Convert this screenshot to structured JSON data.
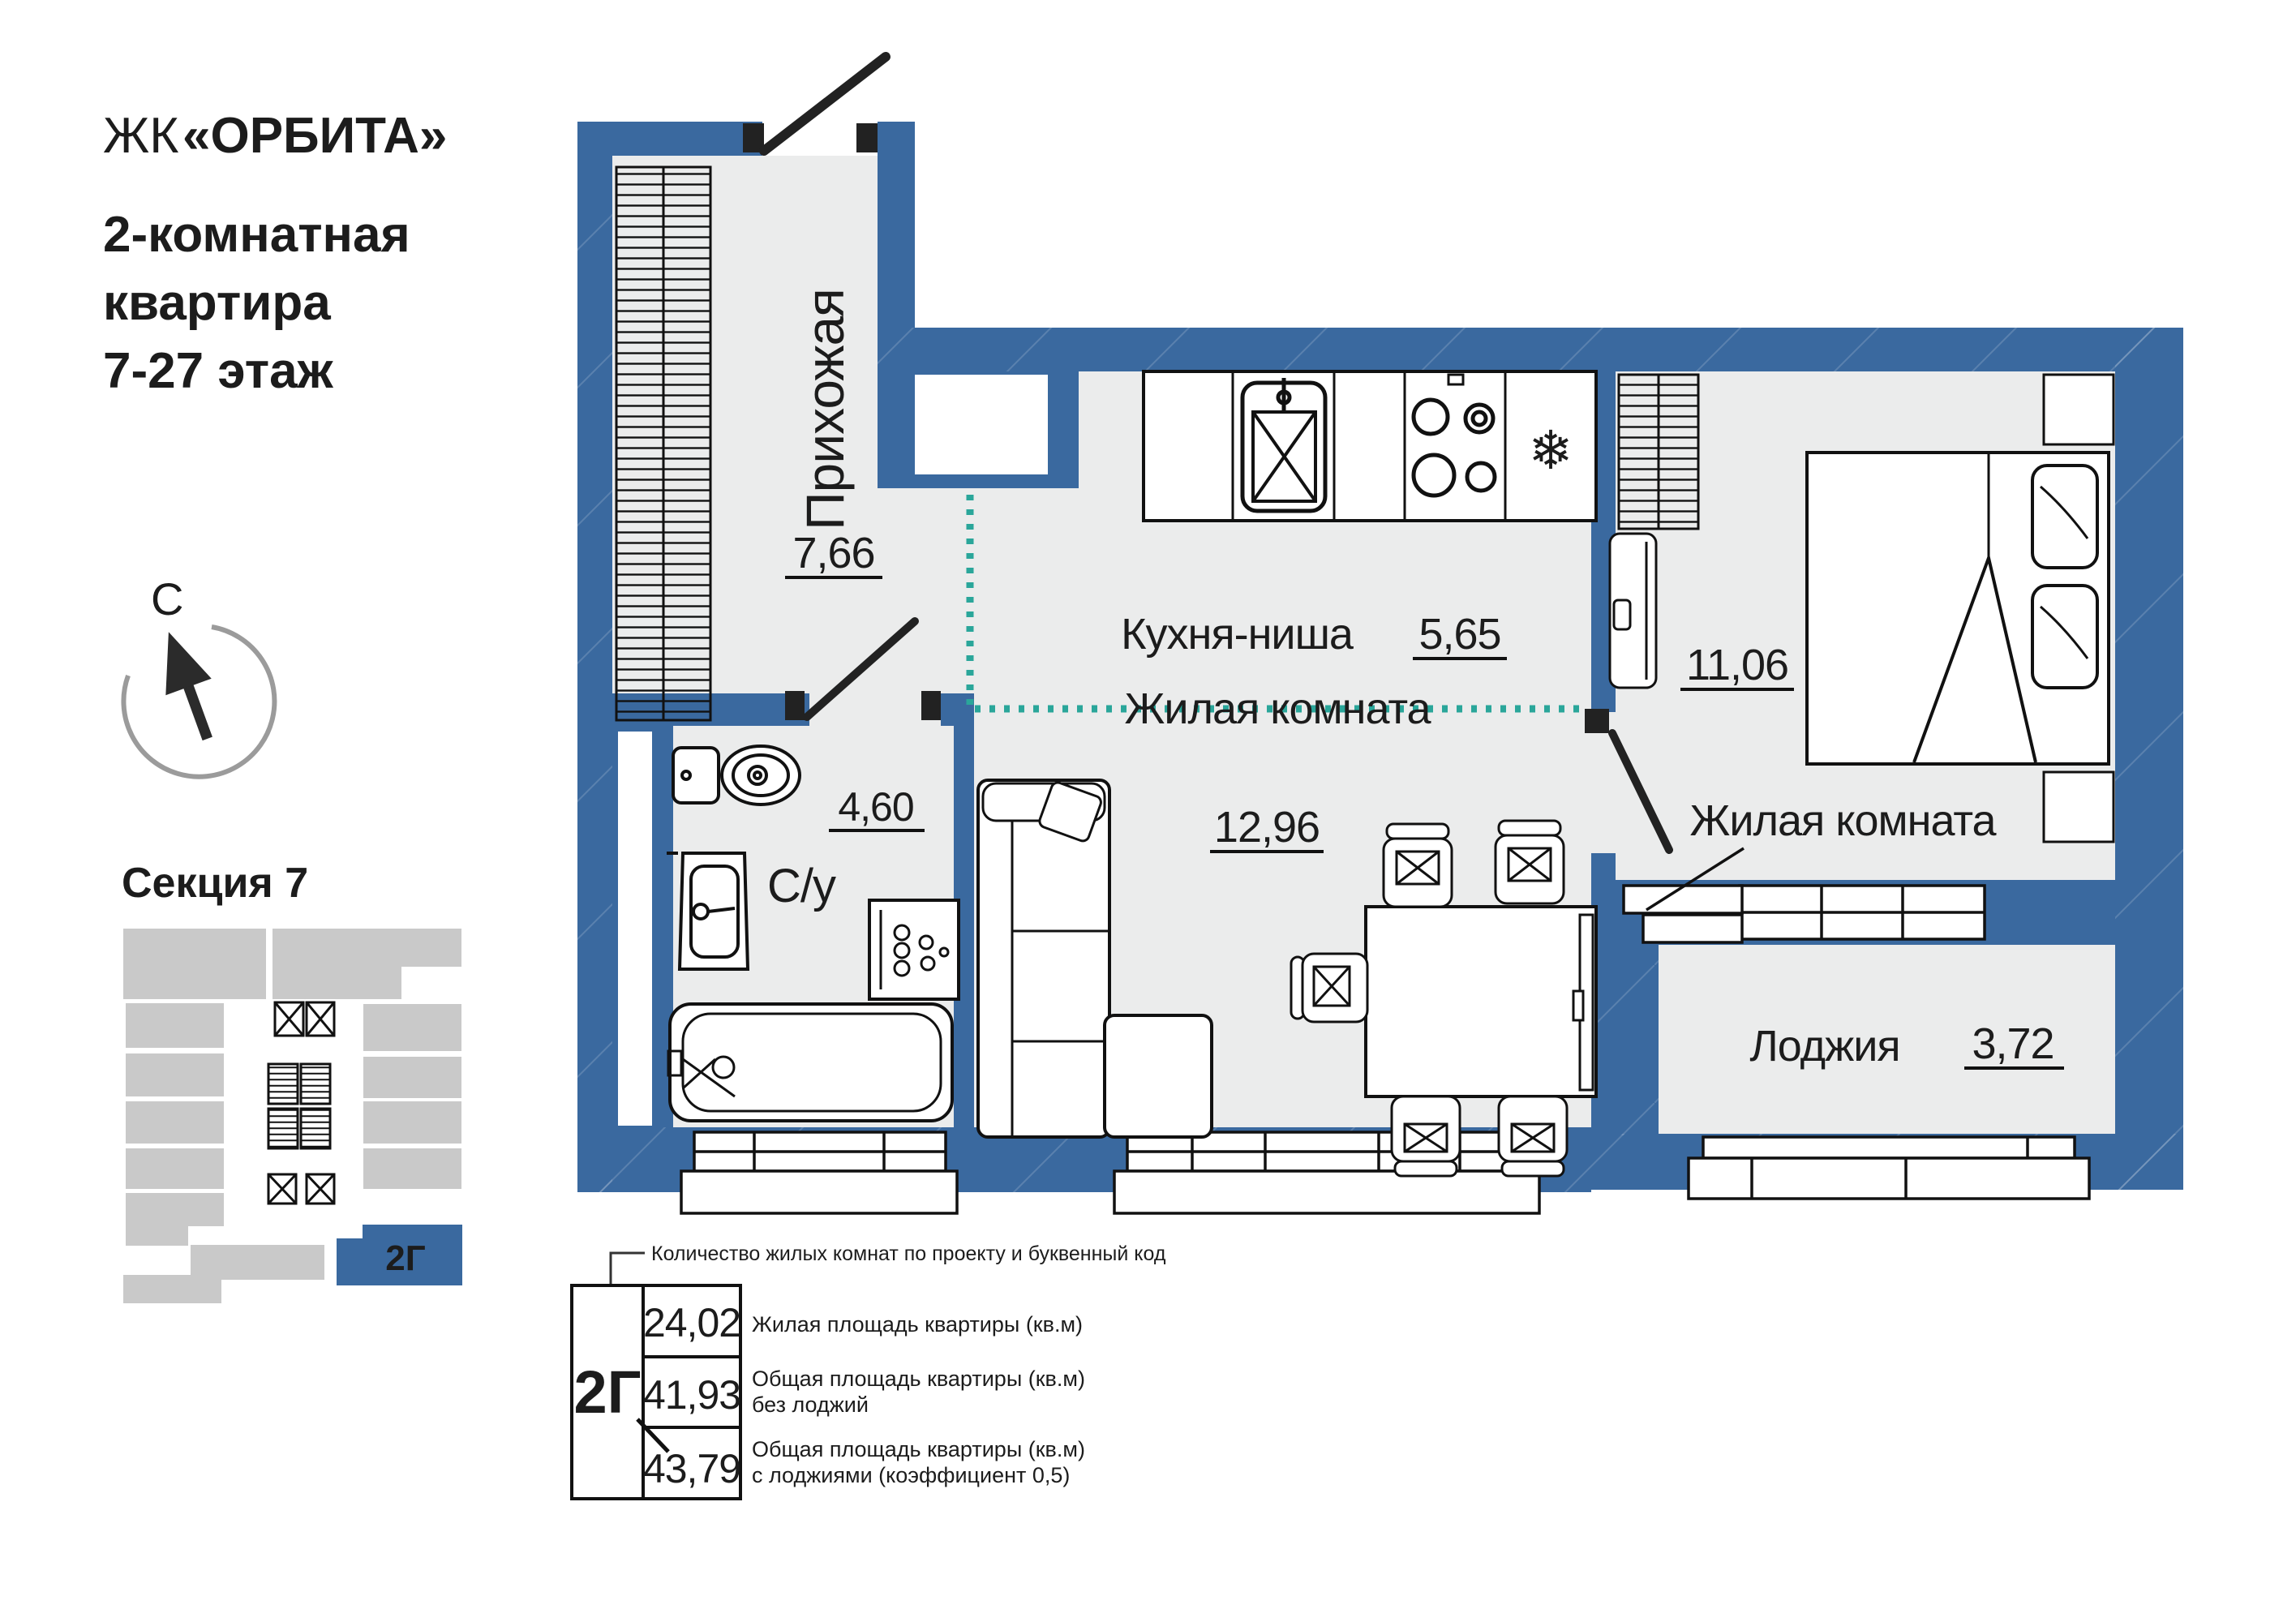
{
  "header": {
    "prefix": "ЖК",
    "name": "«ОРБИТА»",
    "subtitle_lines": [
      "2-комнатная",
      "квартира",
      "7-27 этаж"
    ]
  },
  "compass": {
    "north_label": "С"
  },
  "section": {
    "title": "Секция 7",
    "unit_code": "2Г"
  },
  "plan": {
    "rooms": {
      "hallway": {
        "name": "Прихожая",
        "area": "7,66"
      },
      "kitchen": {
        "name": "Кухня-ниша",
        "area": "5,65"
      },
      "living": {
        "name": "Жилая комната",
        "area": "12,96"
      },
      "bedroom": {
        "name": "Жилая комната",
        "area": "11,06"
      },
      "bathroom": {
        "name": "С/у",
        "area": "4,60"
      },
      "loggia": {
        "name": "Лоджия",
        "area": "3,72"
      }
    }
  },
  "legend": {
    "callout": "Количество жилых комнат по проекту и буквенный код",
    "unit_code": "2Г",
    "rows": [
      {
        "value": "24,02",
        "label": "Жилая площадь квартиры (кв.м)",
        "label2": ""
      },
      {
        "value": "41,93",
        "label": "Общая площадь квартиры (кв.м)",
        "label2": "без лоджий"
      },
      {
        "value": "43,79",
        "label": "Общая площадь квартиры (кв.м)",
        "label2": "с лоджиями (коэффициент 0,5)"
      }
    ]
  },
  "icons": {
    "fridge": "❄"
  },
  "colors": {
    "wall": "#3a699f",
    "interior": "#ebecec",
    "teal_divider": "#2aa69a",
    "minimap_gray": "#c9c9c9",
    "line": "#111111"
  }
}
